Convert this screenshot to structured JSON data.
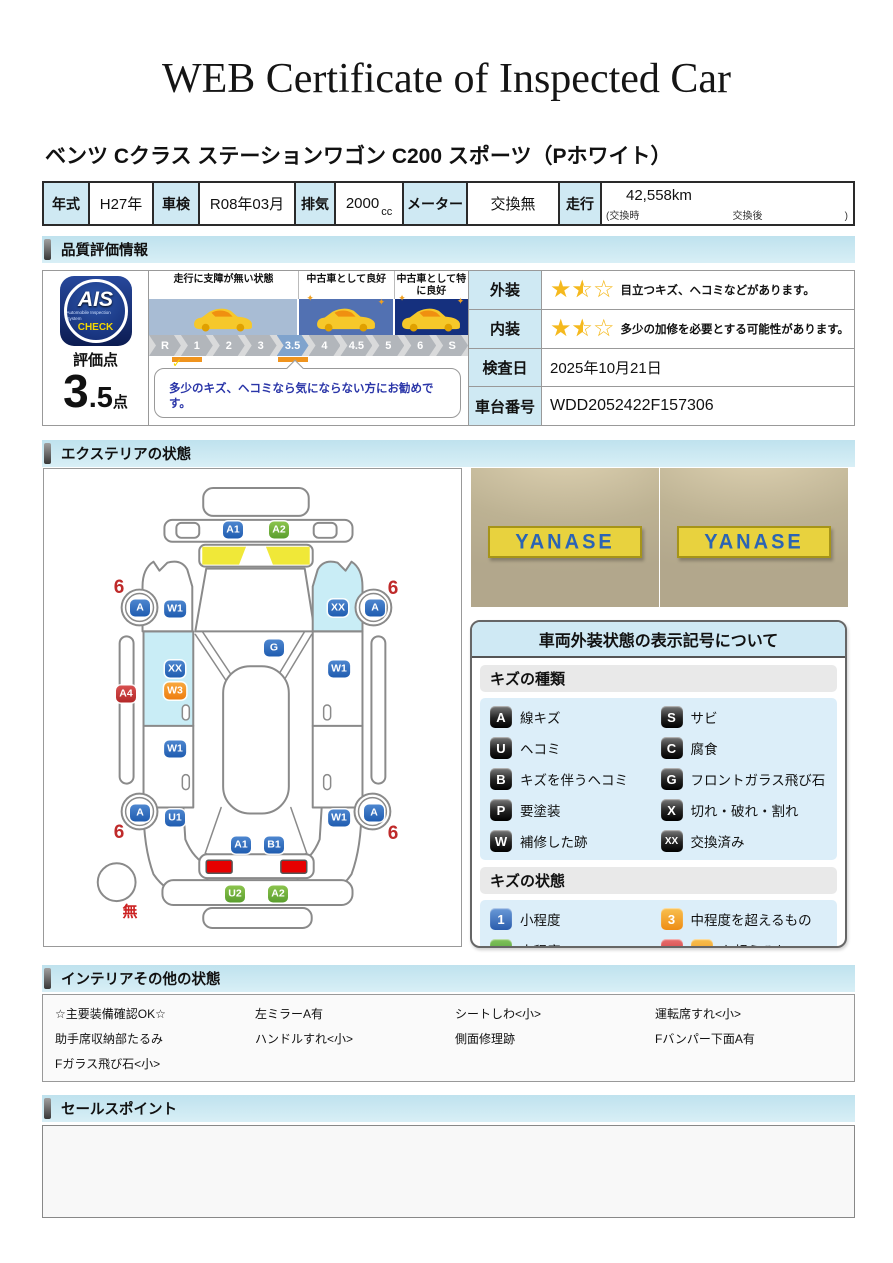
{
  "page": {
    "title": "WEB Certificate of Inspected Car",
    "car_name": "ベンツ Cクラス ステーションワゴン C200 スポーツ（Pホワイト）"
  },
  "spec": {
    "year_label": "年式",
    "year": "H27年",
    "shaken_label": "車検",
    "shaken": "R08年03月",
    "displacement_label": "排気",
    "displacement": "2000",
    "displacement_unit": "cc",
    "meter_label": "メーター",
    "meter": "交換無",
    "mileage_label": "走行",
    "mileage": "42,558km",
    "mileage_sub_left": "(交換時",
    "mileage_sub_mid": "交換後",
    "mileage_sub_right": ")"
  },
  "sections": {
    "quality": "品質評価情報",
    "exterior": "エクステリアの状態",
    "interior": "インテリアその他の状態",
    "sales": "セールスポイント"
  },
  "quality": {
    "logo": {
      "brand": "AIS",
      "brand_sub": "Automobile Inspection System",
      "check": "CHECK",
      "score_label": "評価点",
      "score_int": "3",
      "score_dec": ".5",
      "score_unit": "点"
    },
    "zones": [
      {
        "label": "走行に支障が無い状態",
        "band_color": "#a8bcd4"
      },
      {
        "label": "中古車として良好",
        "band_color": "#5271b2"
      },
      {
        "label": "中古車として特に良好",
        "band_color": "#15307e"
      }
    ],
    "scale": {
      "steps": [
        "R",
        "1",
        "2",
        "3",
        "3.5",
        "4",
        "4.5",
        "5",
        "6",
        "S"
      ],
      "active": "3.5"
    },
    "comment": "多少のキズ、ヘコミなら気にならない方にお勧めです。",
    "ratings": [
      {
        "label": "外装",
        "stars": 1.5,
        "stars_max": 3,
        "text": "目立つキズ、ヘコミなどがあります。"
      },
      {
        "label": "内装",
        "stars": 1.5,
        "stars_max": 3,
        "text": "多少の加修を必要とする可能性があります。"
      }
    ],
    "date_label": "検査日",
    "date": "2025年10月21日",
    "vin_label": "車台番号",
    "vin": "WDD2052422F157306"
  },
  "exterior": {
    "photos": [
      {
        "sign": "YANASE"
      },
      {
        "sign": "YANASE"
      }
    ],
    "markers": [
      {
        "code": "A1",
        "type": "blue",
        "x": 189,
        "y": 61
      },
      {
        "code": "A2",
        "type": "green",
        "x": 235,
        "y": 61
      },
      {
        "code": "A",
        "type": "blue",
        "x": 96,
        "y": 139
      },
      {
        "code": "W1",
        "type": "blue",
        "x": 131,
        "y": 140
      },
      {
        "code": "XX",
        "type": "blue",
        "x": 294,
        "y": 139
      },
      {
        "code": "A",
        "type": "blue",
        "x": 331,
        "y": 139
      },
      {
        "code": "G",
        "type": "blue",
        "x": 230,
        "y": 179
      },
      {
        "code": "A4",
        "type": "red",
        "x": 82,
        "y": 225
      },
      {
        "code": "XX",
        "type": "blue",
        "x": 131,
        "y": 200
      },
      {
        "code": "W3",
        "type": "orange",
        "x": 131,
        "y": 222
      },
      {
        "code": "W1",
        "type": "blue",
        "x": 295,
        "y": 200
      },
      {
        "code": "W1",
        "type": "blue",
        "x": 131,
        "y": 280
      },
      {
        "code": "A",
        "type": "blue",
        "x": 96,
        "y": 344
      },
      {
        "code": "U1",
        "type": "blue",
        "x": 131,
        "y": 349
      },
      {
        "code": "W1",
        "type": "blue",
        "x": 295,
        "y": 349
      },
      {
        "code": "A",
        "type": "blue",
        "x": 330,
        "y": 344
      },
      {
        "code": "A1",
        "type": "blue",
        "x": 197,
        "y": 376
      },
      {
        "code": "B1",
        "type": "blue",
        "x": 230,
        "y": 376
      },
      {
        "code": "U2",
        "type": "green",
        "x": 191,
        "y": 425
      },
      {
        "code": "A2",
        "type": "green",
        "x": 234,
        "y": 425
      }
    ],
    "wheel_notes": [
      {
        "text": "6",
        "x": 75,
        "y": 119
      },
      {
        "text": "6",
        "x": 349,
        "y": 120
      },
      {
        "text": "6",
        "x": 75,
        "y": 364
      },
      {
        "text": "6",
        "x": 349,
        "y": 365
      }
    ],
    "spare_note": {
      "text": "無",
      "x": 86,
      "y": 442
    },
    "legend": {
      "title": "車両外装状態の表示記号について",
      "kinds_title": "キズの種類",
      "kinds": [
        {
          "code": "A",
          "label": "線キズ"
        },
        {
          "code": "S",
          "label": "サビ"
        },
        {
          "code": "U",
          "label": "ヘコミ"
        },
        {
          "code": "C",
          "label": "腐食"
        },
        {
          "code": "B",
          "label": "キズを伴うヘコミ"
        },
        {
          "code": "G",
          "label": "フロントガラス飛び石"
        },
        {
          "code": "P",
          "label": "要塗装"
        },
        {
          "code": "X",
          "label": "切れ・破れ・割れ"
        },
        {
          "code": "W",
          "label": "補修した跡"
        },
        {
          "code": "XX",
          "label": "交換済み"
        }
      ],
      "states_title": "キズの状態",
      "states": [
        {
          "badge": "1",
          "color": "blue",
          "label": "小程度"
        },
        {
          "badge": "3",
          "color": "orange",
          "label": "中程度を超えるもの"
        },
        {
          "badge": "2",
          "color": "green",
          "label": "中程度"
        },
        {
          "badge": "4",
          "color": "red",
          "badge2": "3",
          "badge2_color": "orange",
          "label": "を超えるもの"
        }
      ]
    }
  },
  "interior": {
    "columns": [
      {
        "lines": [
          "☆主要装備確認OK☆",
          "助手席収納部たるみ",
          "Fガラス飛び石<小>"
        ]
      },
      {
        "lines": [
          "左ミラーA有",
          "ハンドルすれ<小>"
        ]
      },
      {
        "lines": [
          "シートしわ<小>",
          "側面修理跡"
        ]
      },
      {
        "lines": [
          "運転席すれ<小>",
          "Fバンパー下面A有"
        ]
      }
    ]
  },
  "sales": {
    "text": ""
  },
  "colors": {
    "section_header_bg": "#c9e7f2",
    "label_cell_bg": "#cfe9f3",
    "badge_blue": "#2f6fc1",
    "badge_green": "#76b43c",
    "badge_orange": "#f0962e",
    "badge_red": "#c83c3c",
    "zone1_band": "#a8bcd4",
    "zone2_band": "#5271b2",
    "zone3_band": "#15307e",
    "scale_active": "#7fa3cd",
    "scale_tick_orange": "#f0941e",
    "star_yellow": "#f5b91e",
    "comment_blue": "#2a35a8",
    "taillight_red": "#e60000",
    "highlight_cyan": "#c9edf6",
    "cowl_yellow": "#f0e838",
    "sign_yellow": "#e8d23e",
    "sign_blue": "#2b64b4"
  }
}
